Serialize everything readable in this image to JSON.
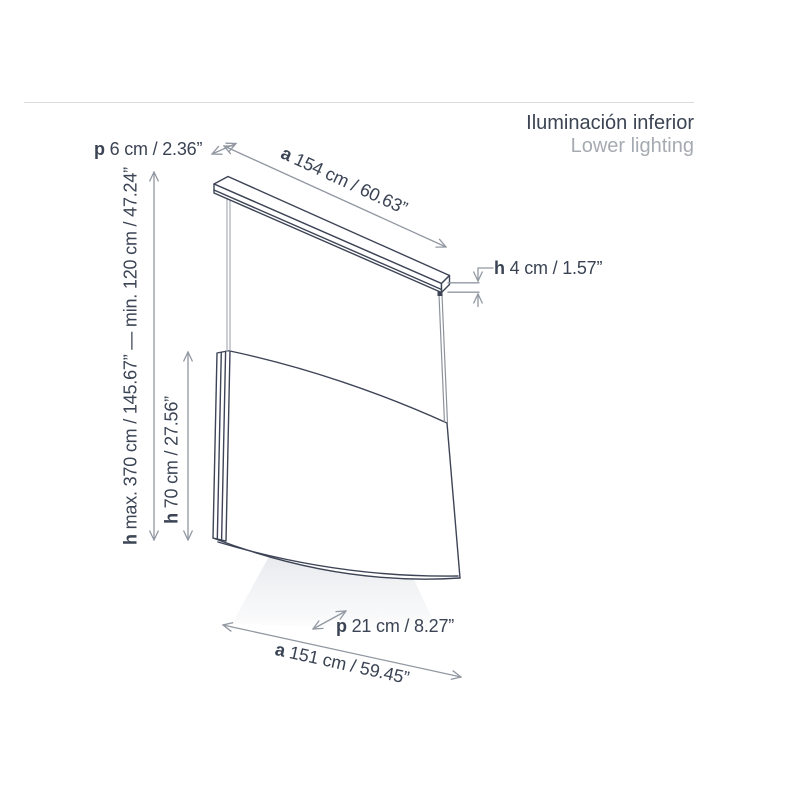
{
  "header": {
    "title_es": "Iluminación inferior",
    "title_en": "Lower lighting"
  },
  "dimensions": {
    "depth_top": {
      "prefix": "p",
      "text": " 6 cm / 2.36”"
    },
    "width_top": {
      "prefix": "a",
      "text": " 154 cm / 60.63”"
    },
    "height_bar": {
      "prefix": "h",
      "text": " 4 cm / 1.57”"
    },
    "height_suspension": {
      "prefix": "h",
      "text": " max. 370 cm / 145.67” — min. 120 cm / 47.24”"
    },
    "height_shade": {
      "prefix": "h",
      "text": " 70 cm / 27.56”"
    },
    "depth_bottom": {
      "prefix": "p",
      "text": " 21 cm / 8.27”"
    },
    "width_bottom": {
      "prefix": "a",
      "text": " 151 cm / 59.45”"
    }
  },
  "colors": {
    "outline": "#3d4456",
    "dimension_line": "#9298a2",
    "label_text": "#3b4454",
    "title_text": "#3c4453",
    "subtitle_text": "#a6abb2",
    "divider": "#d9dadc",
    "wire": "#a8adb5",
    "light_beam": "#dadce2"
  }
}
